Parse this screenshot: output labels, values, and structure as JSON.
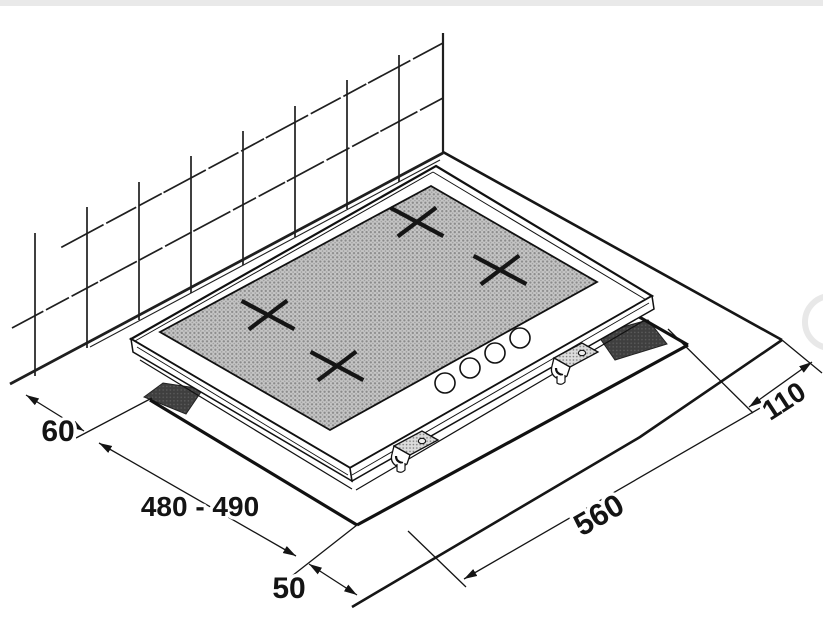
{
  "diagram": {
    "labels": {
      "wall_clearance": "60",
      "cutout_depth": "480 - 490",
      "front_clearance": "50",
      "cutout_width": "560",
      "right_clearance": "110"
    },
    "features": {
      "burner_marks": 4,
      "control_knobs": 4,
      "mounting_brackets": 2
    },
    "colors": {
      "line": "#1a1a1a",
      "glass_fill": "#c6c6c6",
      "glass_dot": "#8a8a8a",
      "opening_dark": "#3f3f3f",
      "bracket_fill": "#d9d9d9",
      "background": "#ffffff",
      "top_bar": "#e9e9e9",
      "watermark": "#e8e8e8"
    }
  }
}
